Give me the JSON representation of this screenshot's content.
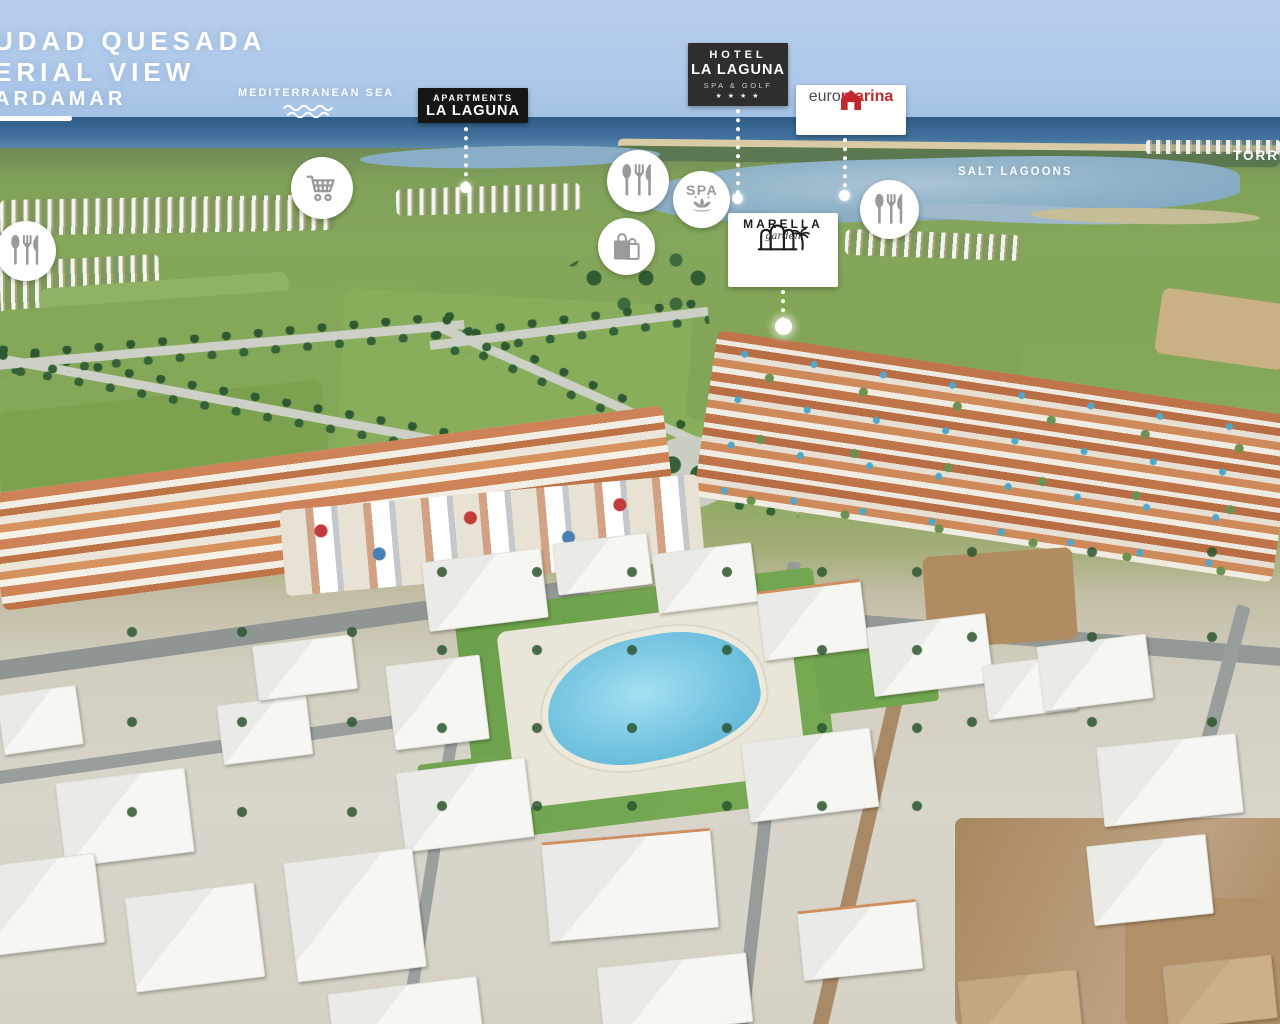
{
  "header": {
    "title_line1": "UDAD QUESADA",
    "title_line2": "ERIAL VIEW",
    "location_label": "ARDAMAR"
  },
  "geo_labels": {
    "sea": "MEDITERRANEAN SEA",
    "salt_lagoons": "SALT LAGOONS",
    "torrevieja": "TORRE"
  },
  "poi": {
    "apartments": {
      "line1": "APARTMENTS",
      "line2": "LA LAGUNA"
    },
    "hotel": {
      "line1": "HOTEL",
      "line2": "LA LAGUNA",
      "line3": "SPA & GOLF",
      "stars": "★ ★ ★ ★"
    },
    "euromarina": {
      "prefix": "euro",
      "suffix": "marina"
    },
    "marella": {
      "name": "MARELLA",
      "subname": "garden"
    }
  },
  "amenities": {
    "spa_label": "SPA",
    "icons": [
      "restaurant-icon",
      "supermarket-cart-icon",
      "restaurant-icon",
      "spa-icon",
      "shopping-bags-icon",
      "restaurant-icon"
    ]
  },
  "colors": {
    "euromarina_red": "#c1272d",
    "label_black": "#161616",
    "hotel_gray": "#2e2e2e",
    "icon_gray": "#9a9a9a",
    "overlay_white": "#ffffff"
  }
}
